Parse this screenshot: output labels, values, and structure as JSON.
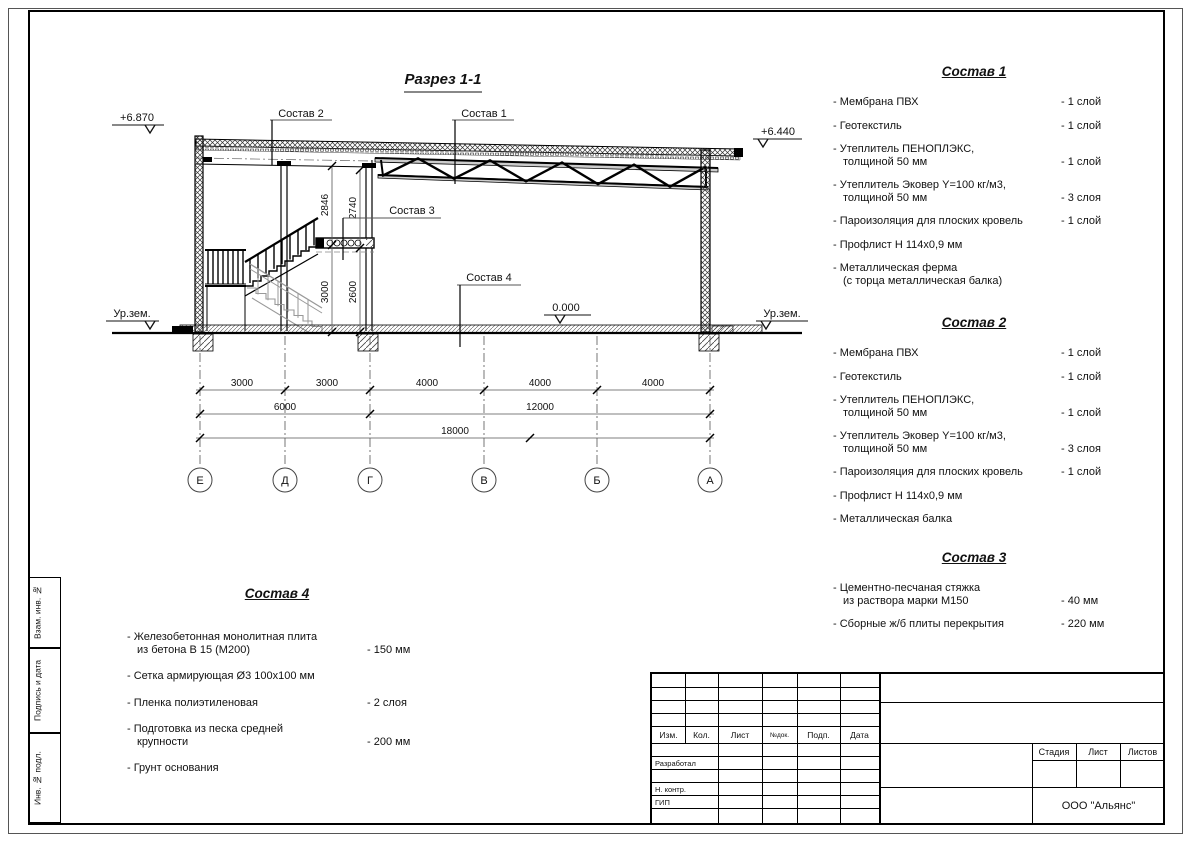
{
  "drawing": {
    "title": "Разрез 1-1",
    "leaders": {
      "c1": "Состав 1",
      "c2": "Состав 2",
      "c3": "Состав 3",
      "c4": "Состав 4"
    },
    "levels": {
      "top_left": "+6.870",
      "top_right": "+6.440",
      "zero": "0.000",
      "ground": "Ур.зем."
    },
    "vdims": [
      "2846",
      "2740",
      "3000",
      "2600"
    ],
    "hdims_row1": [
      "3000",
      "3000",
      "4000",
      "4000",
      "4000"
    ],
    "hdims_row2": [
      "6000",
      "12000"
    ],
    "hdims_row3": "18000",
    "axes": [
      "Е",
      "Д",
      "Г",
      "В",
      "Б",
      "А"
    ]
  },
  "sostav1": {
    "title": "Состав 1",
    "items": [
      {
        "name": "- Мембрана ПВХ",
        "value": "- 1 слой"
      },
      {
        "name": "- Геотекстиль",
        "value": "- 1 слой"
      },
      {
        "name": "- Утеплитель ПЕНОПЛЭКС,",
        "name2": "толщиной 50 мм",
        "value": "- 1 слой"
      },
      {
        "name": "- Утеплитель Эковер Y=100 кг/м3,",
        "name2": "толщиной 50 мм",
        "value": "- 3 слоя"
      },
      {
        "name": "- Пароизоляция для плоских кровель",
        "value": "- 1 слой"
      },
      {
        "name": "- Профлист Н 114х0,9 мм",
        "value": ""
      },
      {
        "name": "- Металлическая ферма",
        "name2": "(с торца металлическая балка)",
        "value": ""
      }
    ]
  },
  "sostav2": {
    "title": "Состав 2",
    "items": [
      {
        "name": "- Мембрана ПВХ",
        "value": "- 1 слой"
      },
      {
        "name": "- Геотекстиль",
        "value": "- 1 слой"
      },
      {
        "name": "- Утеплитель ПЕНОПЛЭКС,",
        "name2": "толщиной 50 мм",
        "value": "- 1 слой"
      },
      {
        "name": "- Утеплитель Эковер Y=100 кг/м3,",
        "name2": "толщиной 50 мм",
        "value": "- 3 слоя"
      },
      {
        "name": "- Пароизоляция для плоских кровель",
        "value": "- 1 слой"
      },
      {
        "name": "- Профлист Н 114х0,9 мм",
        "value": ""
      },
      {
        "name": "- Металлическая балка",
        "value": ""
      }
    ]
  },
  "sostav3": {
    "title": "Состав 3",
    "items": [
      {
        "name": "- Цементно-песчаная стяжка",
        "name2": "из раствора марки М150",
        "value": "- 40 мм"
      },
      {
        "name": "- Сборные ж/б плиты перекрытия",
        "value": "- 220 мм"
      }
    ]
  },
  "sostav4": {
    "title": "Состав 4",
    "items": [
      {
        "name": "- Железобетонная  монолитная плита",
        "name2": "из бетона В 15 (М200)",
        "value": "- 150 мм"
      },
      {
        "name": "- Сетка армирующая Ø3 100х100 мм",
        "value": ""
      },
      {
        "name": "- Пленка полиэтиленовая",
        "value": "- 2 слоя"
      },
      {
        "name": "- Подготовка из песка средней",
        "name2": "крупности",
        "value": "- 200 мм"
      },
      {
        "name": "- Грунт основания",
        "value": ""
      }
    ]
  },
  "titleblock": {
    "header": [
      "Изм.",
      "Кол.",
      "Лист",
      "№док.",
      "Подп.",
      "Дата"
    ],
    "roles": [
      "Разработал",
      "Н. контр.",
      "ГИП"
    ],
    "stage_cols": [
      "Стадия",
      "Лист",
      "Листов"
    ],
    "company": "ООО \"Альянс\""
  },
  "sidebar": [
    "Взам. инв. №",
    "Подпись и дата",
    "Инв. № подл."
  ]
}
